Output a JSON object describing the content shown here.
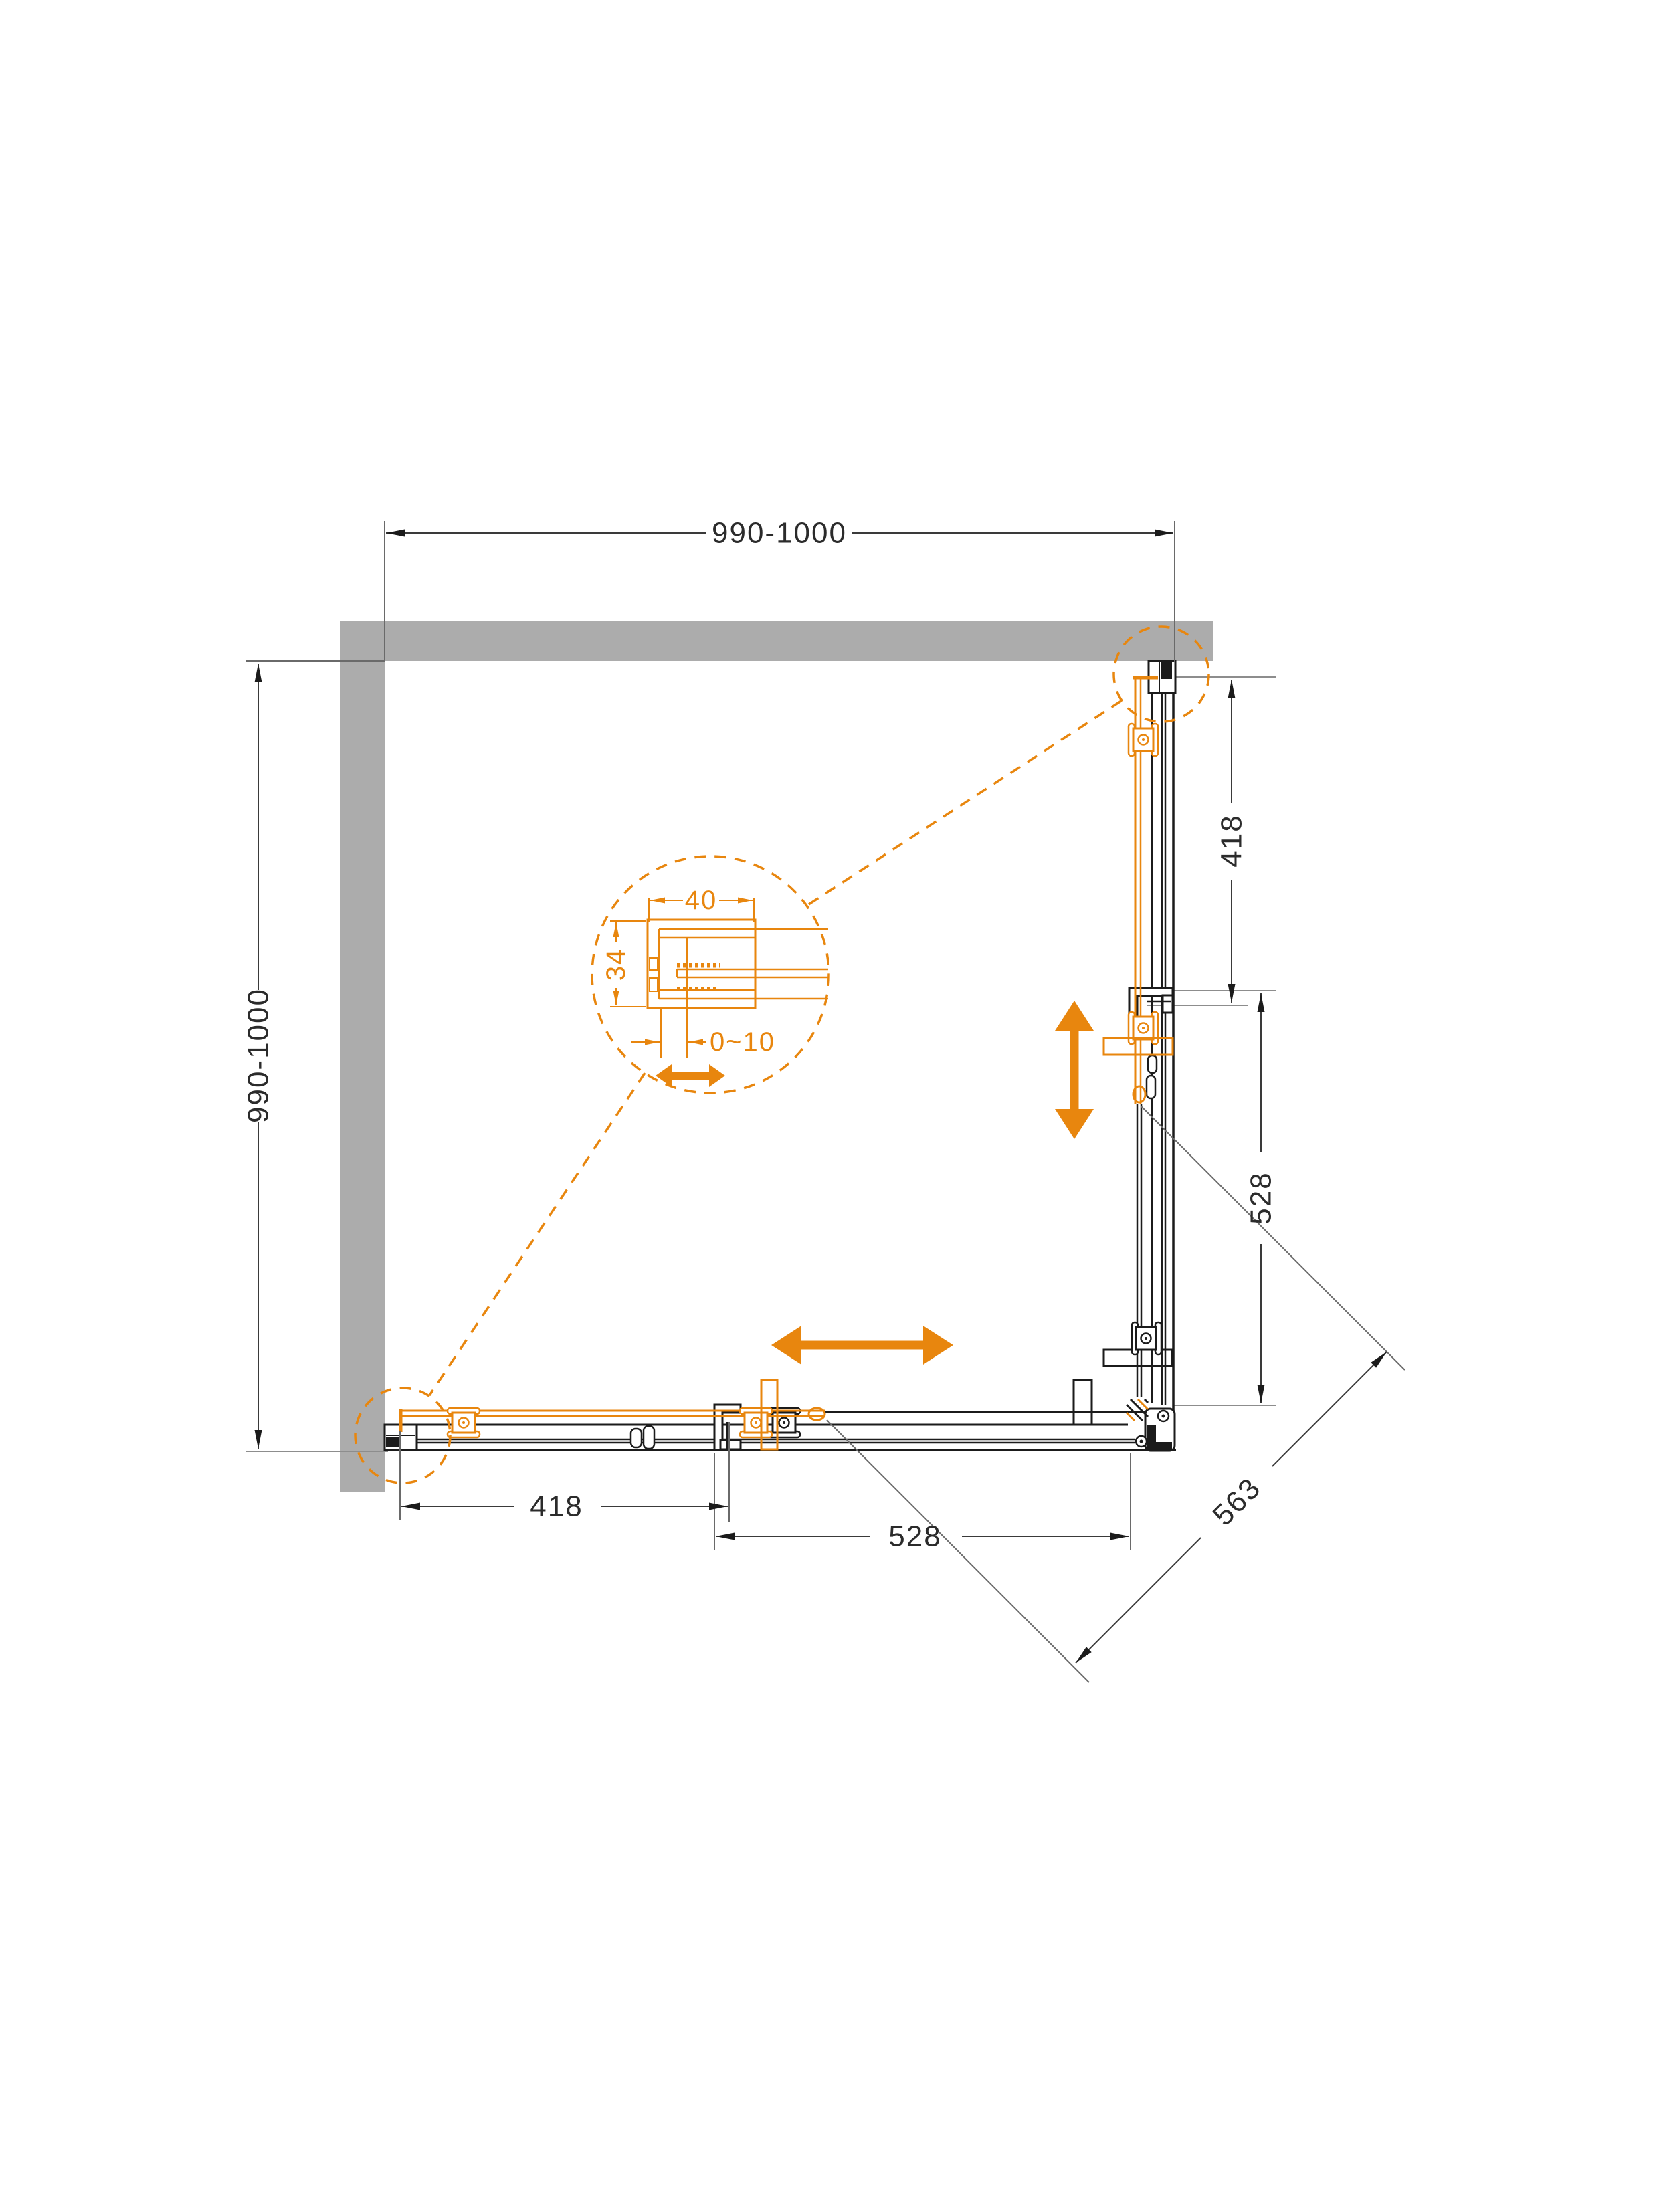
{
  "drawing": {
    "description": "Top-view installation plan of a square corner shower enclosure with two sliding doors, walls on two sides and a magnified wall-profile detail",
    "dims": {
      "top_width": "990-1000",
      "left_depth": "990-1000",
      "right_418": "418",
      "right_528": "528",
      "bottom_418": "418",
      "bottom_528": "528",
      "diagonal_563": "563"
    },
    "detail": {
      "width_40": "40",
      "depth_34": "34",
      "adjust_0_10": "0~10"
    },
    "colors": {
      "accent_orange": "#E8860E",
      "wall_gray": "#ACACAC",
      "frame_black": "#1B1B1B",
      "dim_line_gray": "#3A3A3A",
      "ext_line_gray": "#919191"
    }
  }
}
